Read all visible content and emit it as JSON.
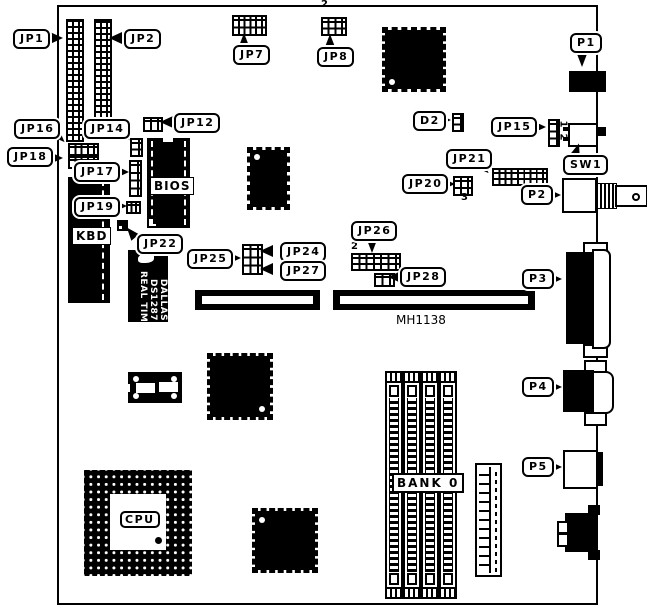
{
  "callouts": {
    "jp1": "JP1",
    "jp2": "JP2",
    "jp7": "JP7",
    "jp8": "JP8",
    "p1": "P1",
    "jp16": "JP16",
    "jp14": "JP14",
    "jp12": "JP12",
    "d2": "D2",
    "jp15": "JP15",
    "jp18": "JP18",
    "sw1": "SW1",
    "jp17": "JP17",
    "jp21": "JP21",
    "jp20": "JP20",
    "p2": "P2",
    "jp19": "JP19",
    "jp22": "JP22",
    "jp26": "JP26",
    "jp25": "JP25",
    "jp24": "JP24",
    "jp27": "JP27",
    "jp28": "JP28",
    "p3": "P3",
    "p4": "P4",
    "p5": "P5"
  },
  "chip_labels": {
    "bios": "BIOS",
    "kbd": "KBD",
    "cpu": "CPU",
    "bank0": "BANK 0"
  },
  "rtc_chip": {
    "line1": "DALLAS",
    "line2": "DS1287",
    "line3": "REAL TIME"
  },
  "silkscreen": {
    "board_code": "MH1138"
  },
  "pin_annotations": {
    "jp8_pin2": "2",
    "jp15_pin1": "1",
    "jp15_pin2": "2",
    "jp20_pin2": "2",
    "jp20_pin3": "3",
    "jp26_pin2": "2"
  }
}
